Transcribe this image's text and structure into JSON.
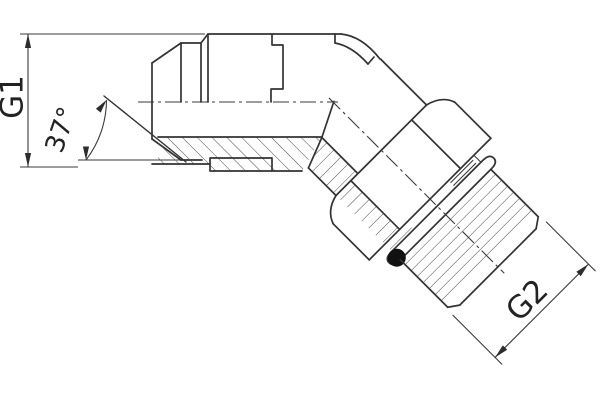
{
  "drawing": {
    "title": "45° elbow fitting, half-section technical drawing",
    "labels": {
      "g1": "G1",
      "g2": "G2",
      "flare_angle": "37°"
    },
    "dimensions": [
      {
        "id": "G1",
        "type": "linear",
        "label": "G1",
        "measures": "horizontal swivel-nut female port size"
      },
      {
        "id": "flare",
        "type": "angular",
        "label": "37°",
        "measures": "flare seat angle"
      },
      {
        "id": "G2",
        "type": "linear",
        "label": "G2",
        "measures": "45° male stud thread size"
      }
    ],
    "features": [
      "swivel-nut-hex",
      "body-step",
      "section-hatching",
      "elbow-45",
      "locknut-hex",
      "washer",
      "o-ring",
      "male-thread",
      "chamfered-tip"
    ],
    "colors": {
      "line": "#333333",
      "hatch": "#4a4a4a",
      "o_ring": "#111111",
      "background": "#ffffff",
      "text": "#222222"
    }
  }
}
